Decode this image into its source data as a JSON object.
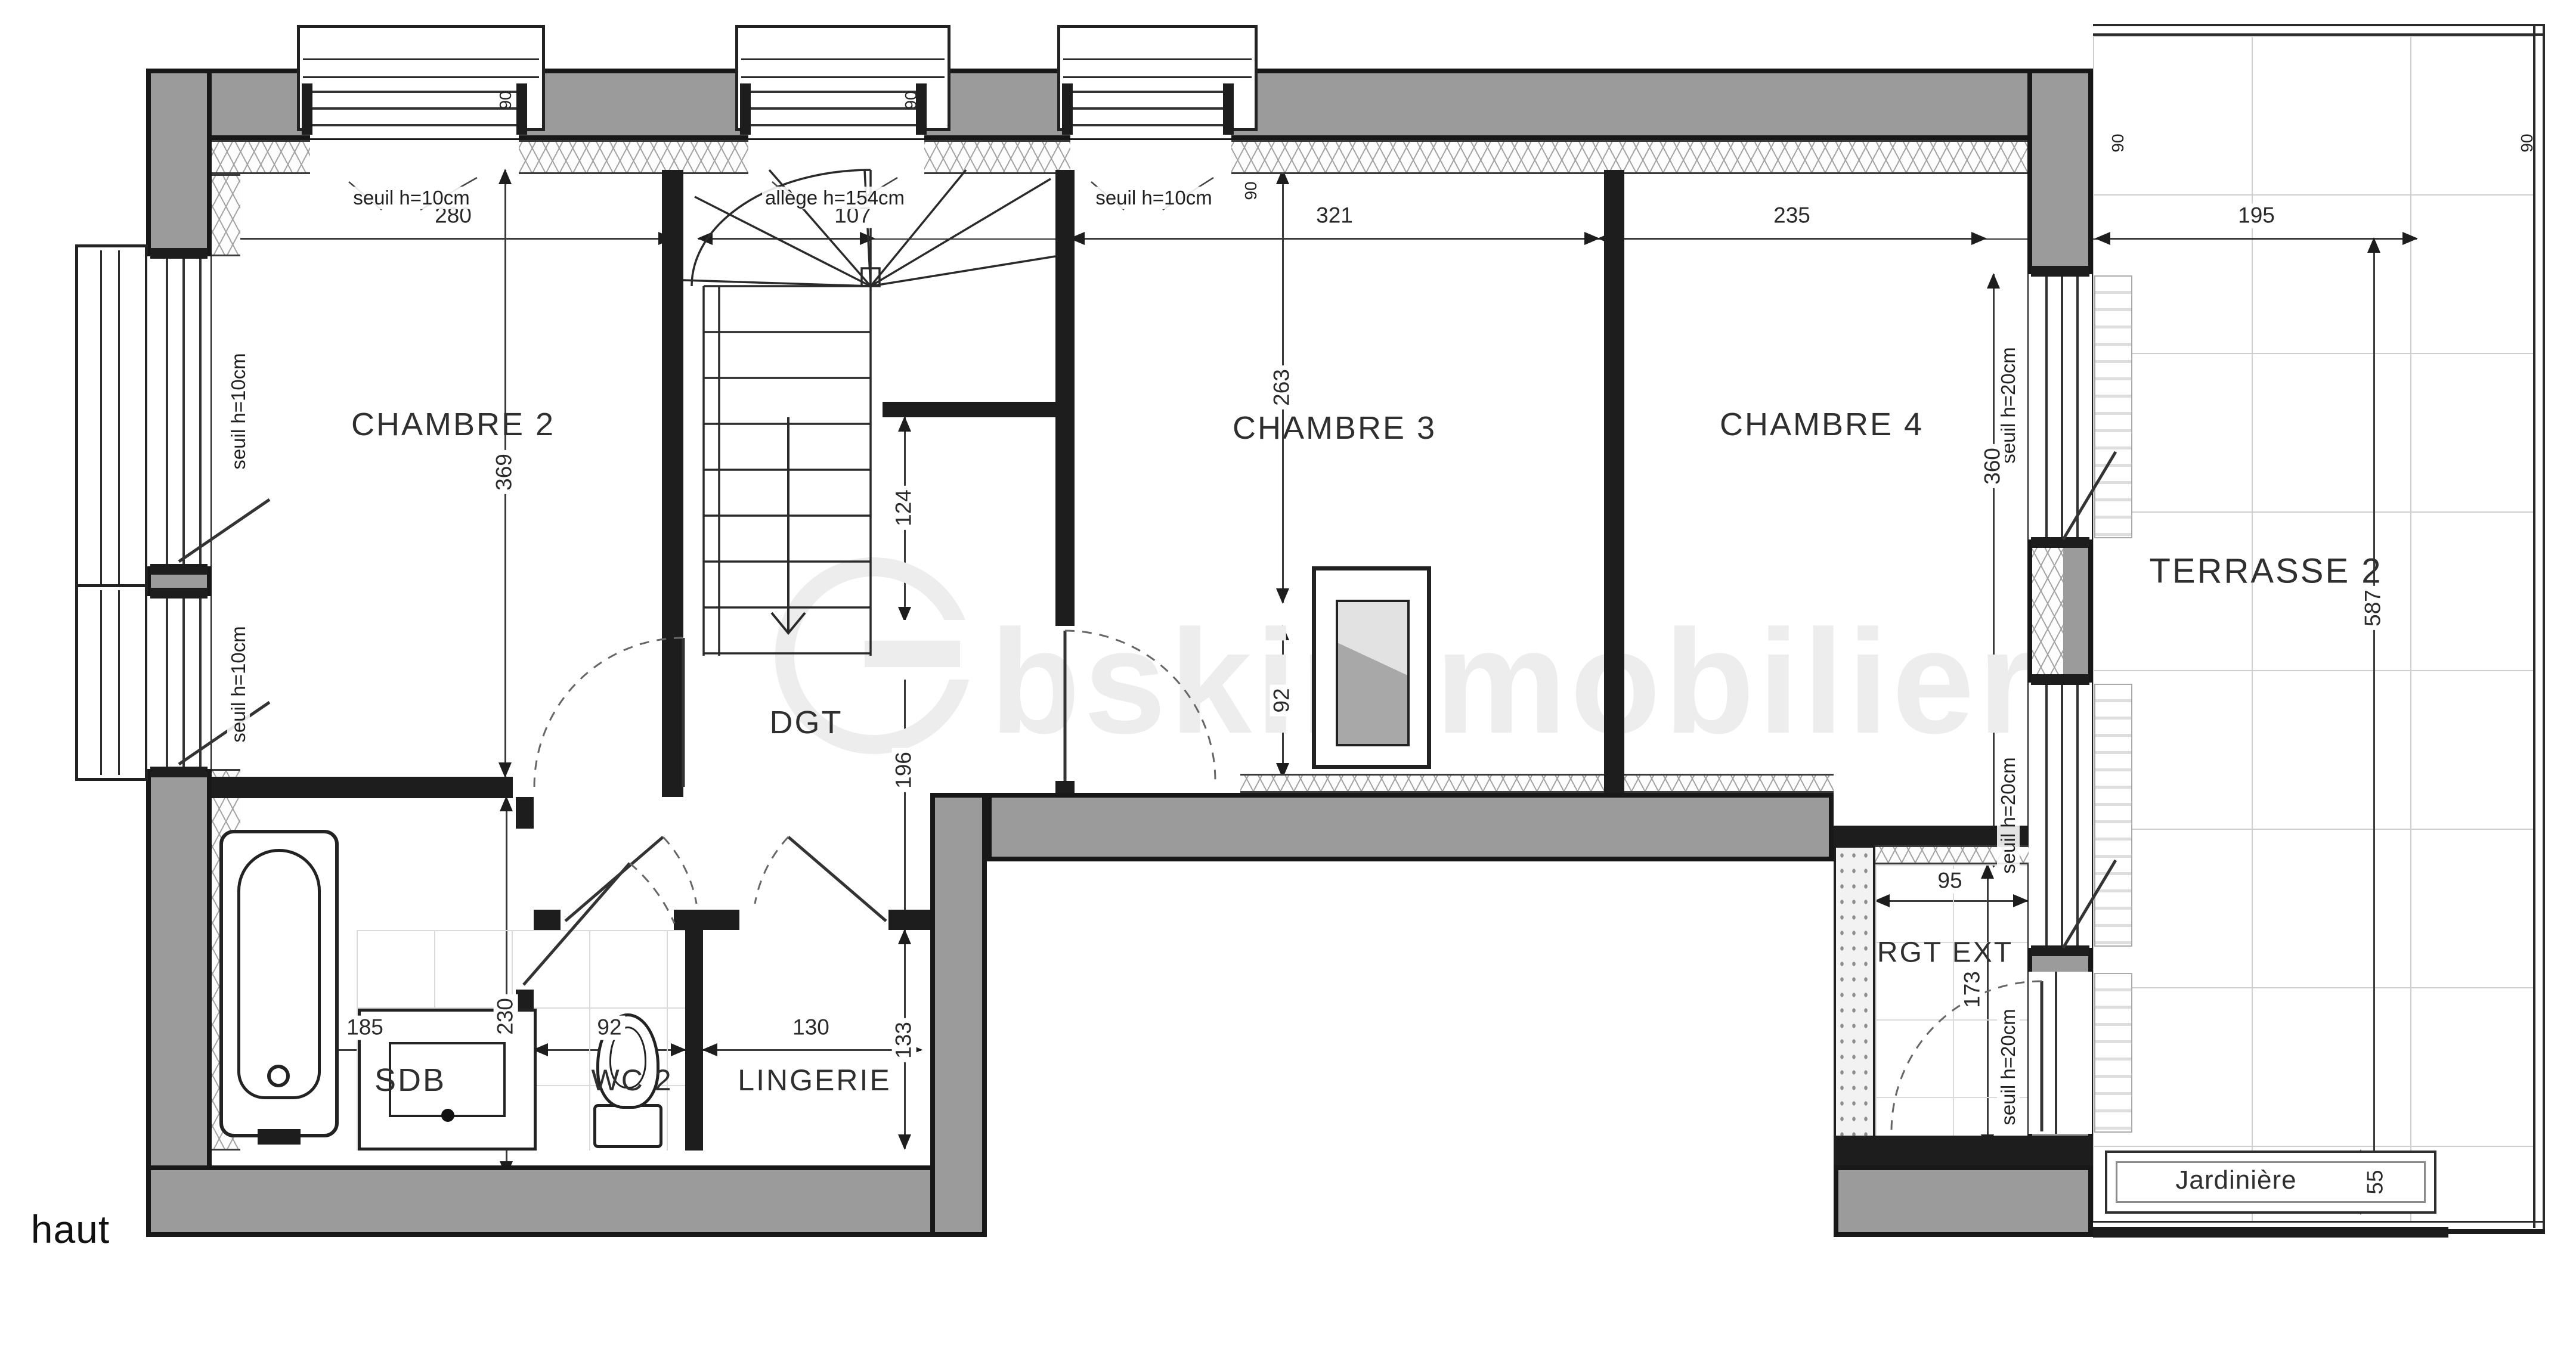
{
  "plan": {
    "floor_label": "haut",
    "watermark_brand": "bskimmobilier"
  },
  "rooms": {
    "chambre2": "CHAMBRE 2",
    "chambre3": "CHAMBRE 3",
    "chambre4": "CHAMBRE 4",
    "terrasse2": "TERRASSE 2",
    "dgt": "DGT",
    "sdb": "SDB",
    "wc2": "WC 2",
    "lingerie": "LINGERIE",
    "rgt_ext": "RGT EXT",
    "jardiniere": "Jardinière"
  },
  "openings": {
    "window_top_1": "seuil h=10cm",
    "window_top_2": "allège h=154cm",
    "window_top_3": "seuil h=10cm",
    "window_left_1": "seuil h=10cm",
    "window_left_2": "seuil h=10cm",
    "slider_right_1": "seuil h=20cm",
    "slider_right_2": "seuil h=20cm",
    "rgt_ext_door": "seuil h=20cm",
    "width_mark": "90"
  },
  "dimensions_cm": {
    "top": {
      "chambre2_width": "280",
      "stair_window": "107",
      "chambre3_width": "321",
      "chambre4_width": "235",
      "terrasse_width": "195"
    },
    "left": {
      "chambre2_depth": "369"
    },
    "middle": {
      "chambre3_depth": "263",
      "chambre3_door": "92",
      "stair_landing": "124",
      "dgt_length": "196",
      "lingerie_depth": "133"
    },
    "right": {
      "sliders_span": "360",
      "terrasse_depth": "587"
    },
    "bottom": {
      "sdb_width": "185",
      "sdb_depth": "230",
      "wc2_width": "92",
      "lingerie_width": "130",
      "rgt_ext_width": "95",
      "rgt_ext_depth": "173",
      "jardiniere_depth": "55"
    }
  },
  "colors": {
    "wall_fill": "#9b9b9b",
    "line": "#1d1d1d",
    "dim_text": "#2a2a2a",
    "tile_line": "#cfcfcf",
    "watermark": "#ededed"
  }
}
